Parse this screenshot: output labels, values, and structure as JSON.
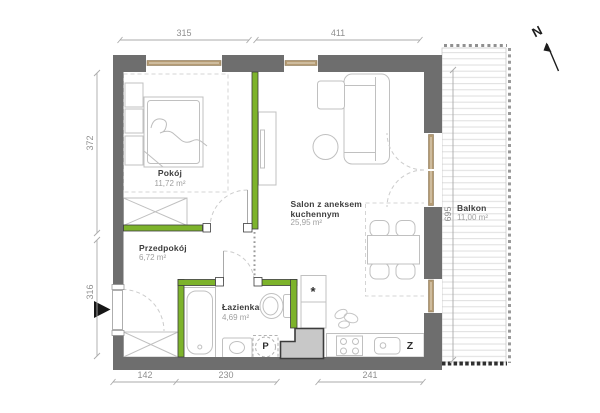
{
  "plan": {
    "compass_label": "N",
    "rooms": [
      {
        "name": "Pokój",
        "area": "11,72 m²"
      },
      {
        "name": "Salon z aneksem",
        "name2": "kuchennym",
        "area": "25,95 m²"
      },
      {
        "name": "Przedpokój",
        "area": "6,72 m²"
      },
      {
        "name": "Łazienka",
        "area": "4,69 m²"
      },
      {
        "name": "Balkon",
        "area": "11,00 m²"
      }
    ],
    "dimensions": {
      "top": [
        "315",
        "411"
      ],
      "left": [
        "372",
        "316"
      ],
      "bottom": [
        "142",
        "230",
        "241"
      ],
      "balcony_height": "695"
    },
    "appliance_labels": {
      "washing_machine": "P",
      "dishwasher": "Z",
      "star": "*"
    },
    "colors": {
      "wall": "#6e6e6e",
      "highlight_wall": "#7db32b",
      "window_frame": "#b59b73",
      "shaft_fill": "#c8c8c8"
    }
  }
}
